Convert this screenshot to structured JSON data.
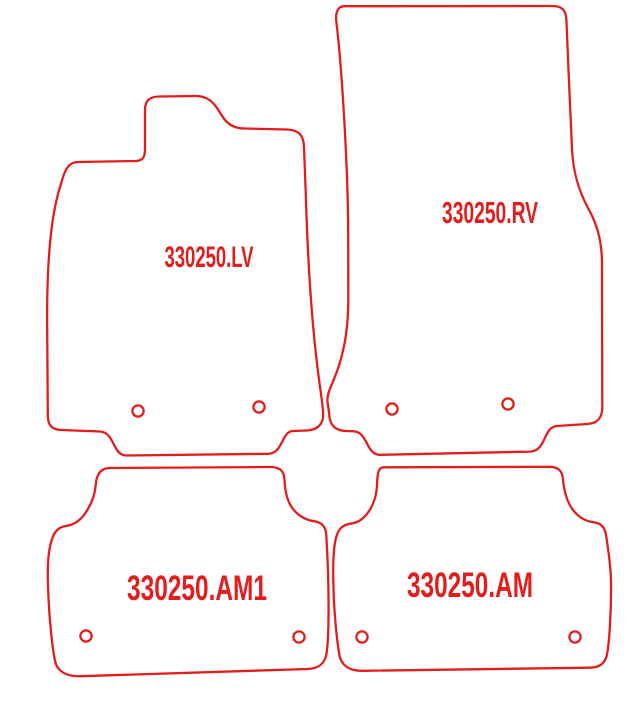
{
  "drawing": {
    "description": "car floor mat cutting pattern set",
    "background_color": "#ffffff",
    "line_color": "#e31c1c",
    "line_width": 2.3,
    "canvas": {
      "width": 639,
      "height": 704
    },
    "mats": [
      {
        "id": "front-left",
        "label": "330250.LV",
        "label_x": 209,
        "label_baseline_y": 267,
        "label_font_size": 30,
        "label_length": 89,
        "hole_radius": 5.6,
        "holes": [
          {
            "cx": 138,
            "cy": 411
          },
          {
            "cx": 259,
            "cy": 407
          }
        ],
        "outline_path": "M 78 162 L 136 161 C 144 160.5 145 156 145 148 L 145 110 C 145 100 150 96.5 160 96.5 L 196 96 C 208 96 214 103 219 111 C 223.5 118.5 227 124 235 127 C 238 128 241 128.5 245 128.5 L 287 129.5 C 299 130 303.5 135 304 147 L 306 200 C 308 268 312.5 336 321 394 C 322.5 404 323 409 323.2 414 C 323.5 423 318.5 430 307 430.5 L 293 431 C 281 431.5 283.5 453 268.5 453.8 L 127 455.5 C 112 456 115.5 432.5 100 431.5 L 61 430 C 51 429.5 47.8 424.5 47.8 415 L 47.2 330 C 46.5 262 51 213 61 184 C 64.5 170 68.5 162 78 162 Z"
      },
      {
        "id": "front-right",
        "label": "330250.RV",
        "label_x": 490,
        "label_baseline_y": 223,
        "label_font_size": 31,
        "label_length": 96,
        "hole_radius": 5.6,
        "holes": [
          {
            "cx": 392,
            "cy": 409
          },
          {
            "cx": 508,
            "cy": 404
          }
        ],
        "outline_path": "M 344 6.2 L 553 6 C 562 6 566 10.5 566.4 19.5 C 568 60 570.3 112 572 149 C 573 170 577.5 188.5 588 208 C 596.5 223 601.5 239 602 261 L 602.3 407 C 602.3 418 597.5 423.3 587.5 424 L 557 426 C 543 427 546.6 450.5 530.5 451.6 L 381 454.8 C 365 455.4 369 432 353 431.2 L 345.5 431 C 335.5 430.5 330 425 329.3 415.5 C 328.8 410 328.2 406 327.6 402.5 C 326.5 395.5 330 388.5 333.6 380 C 337 372 340.3 362.5 342.8 351.5 C 346.2 337.5 348.2 321 348.3 301 L 348.2 231 C 347.8 161 341.3 62 336.4 22.5 C 335 11.5 338.5 6.2 344 6.2 Z"
      },
      {
        "id": "rear-left",
        "label": "330250.AM1",
        "label_x": 197,
        "label_baseline_y": 600,
        "label_font_size": 35,
        "label_length": 140,
        "hole_radius": 5.6,
        "holes": [
          {
            "cx": 86,
            "cy": 636
          },
          {
            "cx": 299,
            "cy": 637
          }
        ],
        "outline_path": "M 110 468 L 270 467 C 280 467 284.3 471 284.5 480 C 285 493.5 288 504 295 511.3 C 300.8 517.3 306.6 520.2 314 521.2 C 322 522.3 325.8 526.8 326.3 535 L 328 570 C 329 610 328.4 641 326.6 653 C 325 664 318.6 668.6 307.5 669 L 81 676.2 C 68.5 676.6 57.8 672.8 55.2 661.5 C 52.3 649 48.2 611 47.8 576 C 47.6 558 49.3 546 52.6 537.6 C 55 531.2 58.4 527.2 66 526 C 73.8 524.8 79.3 521.3 84.4 514.4 C 90.4 506.3 94.8 497 95.8 484.5 C 96.6 473.6 101 468 110 468 Z"
      },
      {
        "id": "rear-right",
        "label": "330250.AM",
        "label_x": 470,
        "label_baseline_y": 597,
        "label_font_size": 35,
        "label_length": 126,
        "hole_radius": 5.6,
        "holes": [
          {
            "cx": 362,
            "cy": 637
          },
          {
            "cx": 575,
            "cy": 637
          }
        ],
        "outline_path": "M 384 467.3 L 549.5 466.8 C 558.5 466.8 562.2 471 563 479.3 C 564.2 492.6 567.3 503.3 574 511.2 C 580 518.2 586 521.2 594 522.3 C 602 523.4 605.3 528.3 606.3 536.5 C 608.4 551 610.8 566 611 581 C 611.4 611 609.3 641 607.3 653 C 605.5 663.8 599.6 667.4 589.5 667.7 L 362.5 670.8 C 350.5 671 341.3 666.3 339.3 654.5 C 336.5 637.5 333.2 606 333.2 571 C 333.2 554 334.3 543.5 336.3 536.8 C 338.4 529.3 342.3 524.9 350 523.8 C 357.7 522.7 363 519.5 368 512.6 C 374 504.4 376.8 495 377.1 483.5 C 377.4 472.3 378.8 467.3 384 467.3 Z"
      }
    ]
  }
}
